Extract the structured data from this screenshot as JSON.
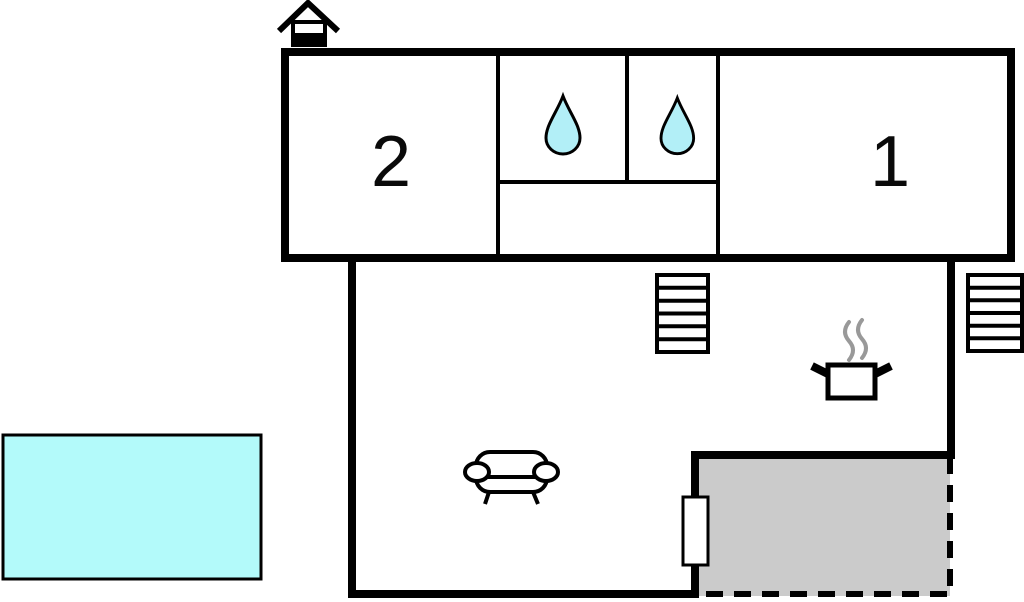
{
  "floor_plan": {
    "rooms": [
      {
        "id": "room-2",
        "label": "2"
      },
      {
        "id": "room-1",
        "label": "1"
      }
    ],
    "features": [
      "house-marker-icon",
      "water-drop-icon-left",
      "water-drop-icon-right",
      "stairs-icon-middle",
      "stairs-icon-right",
      "cooking-pot-icon",
      "steam-icon",
      "sofa-icon",
      "door-marker",
      "terrace-area",
      "pool-area"
    ],
    "colors": {
      "wall": "#000000",
      "background": "#FFFFFF",
      "pool_fill": "#B3FAFA",
      "drop_fill": "#B2EFF7",
      "terrace_fill": "#CBCBCB",
      "steam_stroke": "#999999",
      "label_color": "#0A0A0A"
    }
  }
}
